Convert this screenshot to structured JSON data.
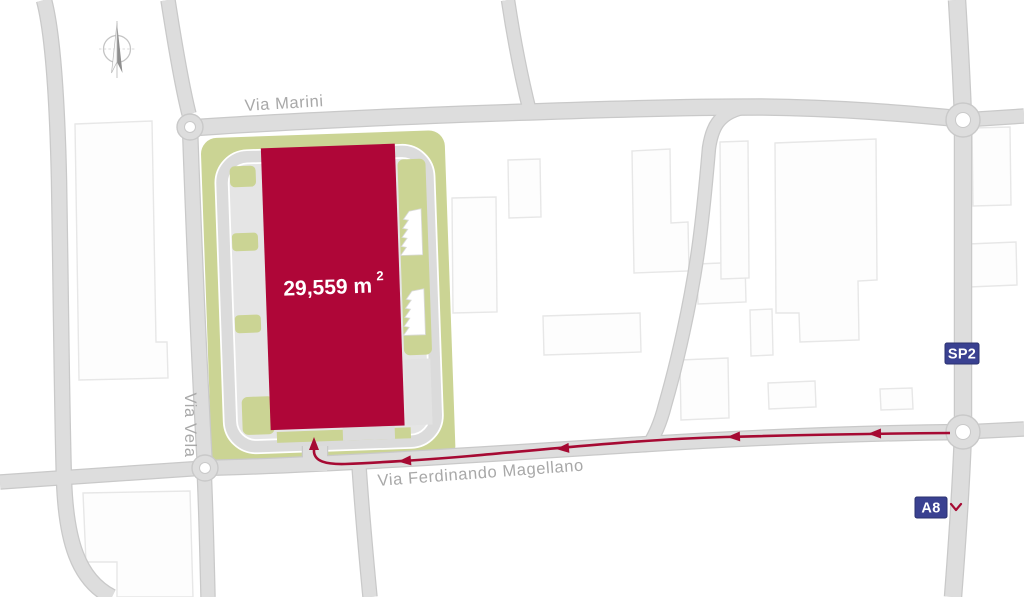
{
  "site": {
    "area_value": "29,559 m",
    "area_sup": "2"
  },
  "streets": {
    "marini": "Via Marini",
    "vela": "Via Vela",
    "magellano": "Via Ferdinando Magellano"
  },
  "badges": {
    "sp2": "SP2",
    "a8": "A8"
  },
  "icons": {
    "compass": "compass-north-icon",
    "a8_chevron": "chevron-down-icon"
  },
  "colors": {
    "building": "#AF0638",
    "site_green": "#CBD494",
    "road": "#DDDDDD",
    "road_casing": "#C9C9C9",
    "route": "#A60A33",
    "badge_navy": "#3A4191",
    "street_label": "#A8A8A8"
  }
}
